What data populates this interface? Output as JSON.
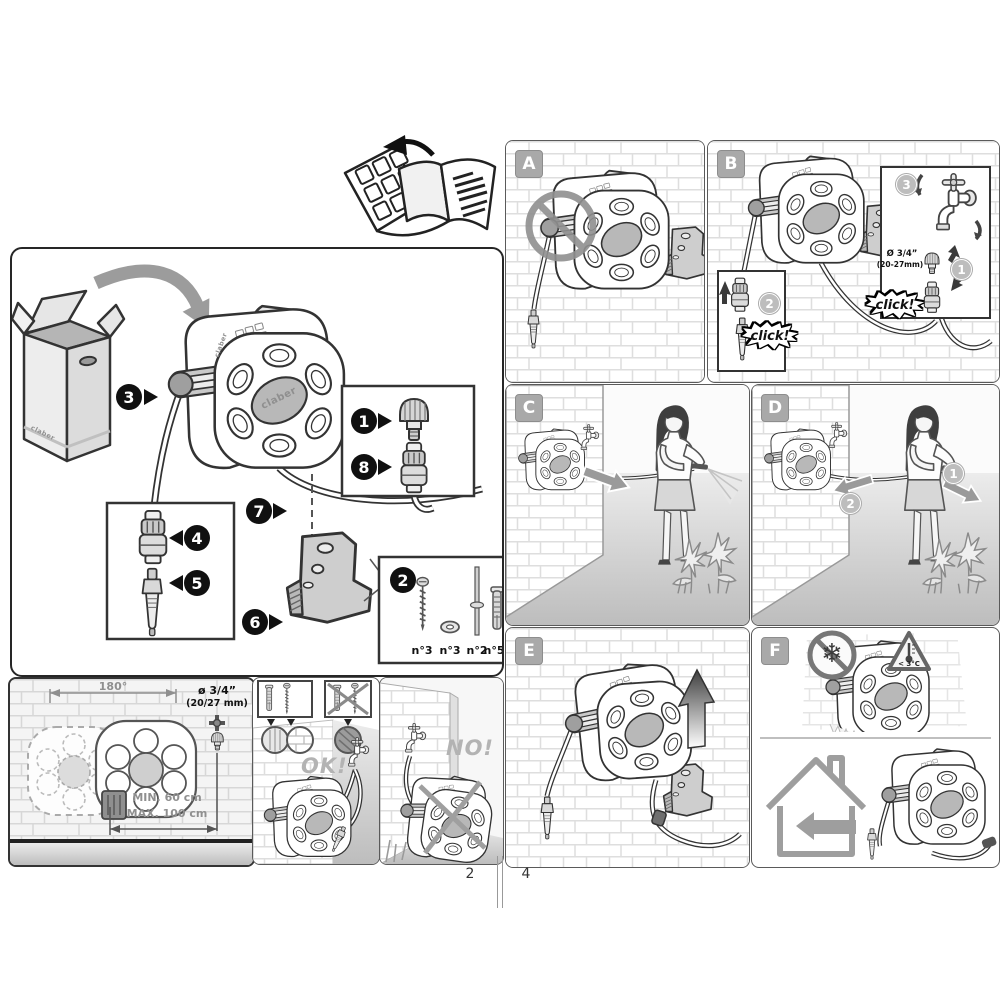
{
  "page": {
    "left_number": "2",
    "right_number": "4"
  },
  "brand": {
    "name": "claber"
  },
  "icons": {
    "snowflake": "❄"
  },
  "unpacking": {
    "callouts": {
      "c1": "1",
      "c2": "2",
      "c3": "3",
      "c4": "4",
      "c5": "5",
      "c6": "6",
      "c7": "7",
      "c8": "8"
    },
    "hardware": {
      "screw": "n°3",
      "washer": "n°3",
      "pin": "n°2",
      "plug": "n°5"
    }
  },
  "mounting": {
    "rotation": "180°",
    "diameter": "ø 3/4”",
    "diameter_mm": "(20/27 mm)",
    "min": "MIN. 60 cm",
    "max": "MAX. 100 cm"
  },
  "approval": {
    "ok": "OK!",
    "no": "NO!"
  },
  "steps": {
    "a": {
      "letter": "A"
    },
    "b": {
      "letter": "B",
      "n1": "1",
      "n2": "2",
      "n3": "3",
      "click_hose": "click!",
      "click_tap": "click!",
      "diameter": "Ø 3/4”",
      "diameter_mm": "(20-27mm)"
    },
    "c": {
      "letter": "C"
    },
    "d": {
      "letter": "D",
      "n1": "1",
      "n2": "2"
    },
    "e": {
      "letter": "E"
    },
    "f": {
      "letter": "F",
      "temperature": "< 3°C"
    }
  }
}
